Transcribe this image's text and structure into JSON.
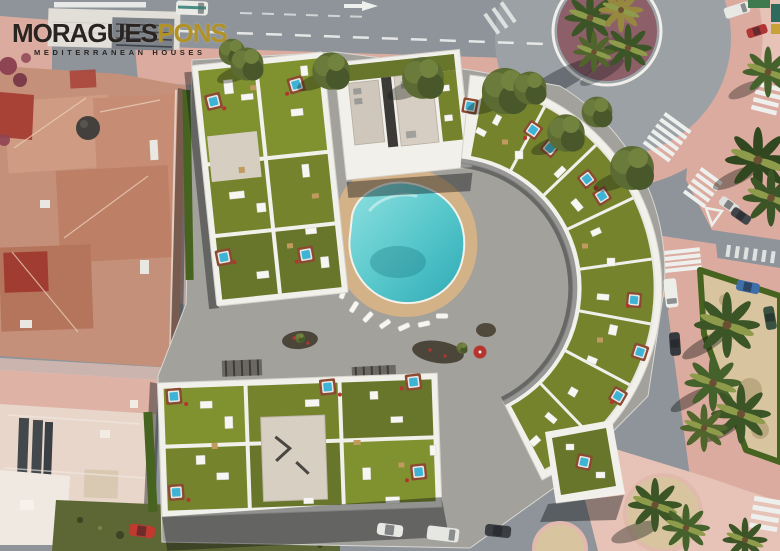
{
  "logo": {
    "brand_primary": "MORAGUES",
    "brand_secondary": "PONS",
    "tagline": "MEDITERRANEAN HOUSES"
  },
  "scene": {
    "type": "aerial-architectural-render",
    "elements": [
      "roundabout with plum-colored palm island",
      "new apartment complex with roof-garden terraces",
      "rooftop jacuzzis with wooden surrounds",
      "central courtyard with teardrop swimming pool and sun loungers",
      "existing terracotta-roof buildings on the left",
      "streets with zebra crossings, lane dashes and parked cars",
      "triangular sand park bordered by hedge with palm trees",
      "circular sand planters with palms",
      "olive street trees on pink sidewalks",
      "vacant scrub lot with red car"
    ]
  },
  "palette": {
    "road": "#8e9499",
    "road_light": "#9ba1a5",
    "sidewalk": "#dcab9f",
    "sidewalk_light": "#e7c2b6",
    "island_plum": "#8d5f68",
    "sand": "#d8c5a0",
    "scrub": "#5d6635",
    "lawn": "#74832c",
    "lawn_dark": "#67762a",
    "lawn_light": "#80912f",
    "hedge": "#46631f",
    "paving": "#a2a19c",
    "building_white": "#f2f0ea",
    "core_beige": "#d8cfc3",
    "deck_tan": "#d4b287",
    "pool_deep": "#3fb7c0",
    "pool_shallow": "#8fe0e0",
    "jacuzzi_blue": "#3db4d6",
    "jacuzzi_frame": "#8c4a33",
    "roof_terracotta": "#c59079",
    "roof_red": "#a84136",
    "roof_pale": "#e8d6cb",
    "tree_olive": "#5b6b33",
    "palm_green": "#3c5526",
    "marking_white": "#eef0ee",
    "logo_ink": "#2a2421",
    "logo_gold": "#b29227"
  }
}
